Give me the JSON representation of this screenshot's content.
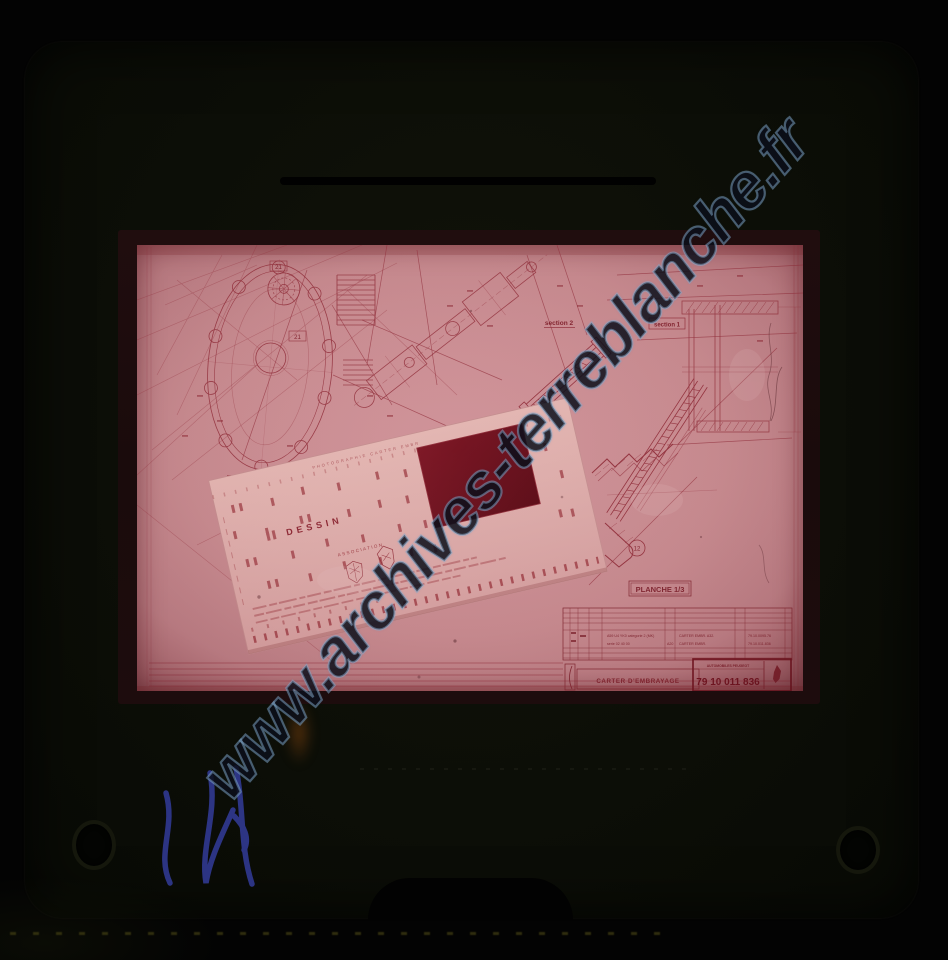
{
  "watermark": {
    "text": "www.archives-terreblanche.fr"
  },
  "drawing": {
    "section_labels": {
      "s2": "section 2",
      "s1": "section 1"
    },
    "plate_label": "PLANCHE 1/3",
    "callouts": {
      "c21": "21",
      "c12": "12"
    },
    "title_block": {
      "row1": {
        "desc": "A59 U4 YK0 categorie 2 (MK)",
        "part": "CARTER EMBR. A32.",
        "ref": "79.10.0095.76"
      },
      "row2": {
        "desc": "serie 02 40 00",
        "code": "A20",
        "part": "CARTER EMBR.",
        "ref": "79.10.011.836"
      },
      "title": "CARTER D'EMBRAYAGE",
      "manufacturer": "AUTOMOBILES PEUGEOT",
      "drawing_number": "79 10 011 836"
    }
  },
  "aperture_card": {
    "heading": "DESSIN",
    "association": "ASSOCIATION",
    "top_microtext": "PHOTOGRAPHIE      CARTER EMBR"
  },
  "colors": {
    "film_pink": "#c78b90",
    "ink_red": "#93323e",
    "window_red": "#701320",
    "mount_dark": "#0d0f09",
    "watermark_outline": "#82aacd",
    "scribble_blue": "#333c9a"
  }
}
